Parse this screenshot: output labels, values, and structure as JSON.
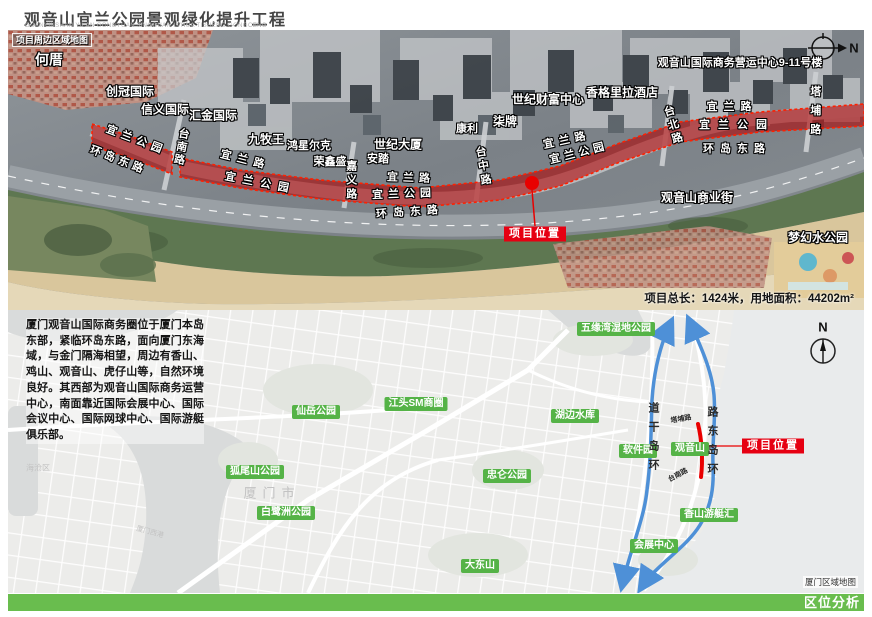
{
  "header": {
    "title": "观音山宜兰公园景观绿化提升工程",
    "subtitle": "GUANYINSHAN YILAN GONGYUAN JINGGUAN LVHUA TISHENG GONGCENG"
  },
  "colors": {
    "accent_green": "#69bd4e",
    "badge_green": "#55b347",
    "project_red": "#e60012",
    "band_red": "#b20000",
    "route_blue": "#4e90d7"
  },
  "top_map": {
    "corner_label": "项目周边区域地图",
    "compass_n": "N",
    "stats": "项目总长：1424米，用地面积：44202m²",
    "project_badge": "项目位置",
    "labels": [
      {
        "t": "何厝",
        "x": 41,
        "y": 30,
        "s": 14
      },
      {
        "t": "创冠国际",
        "x": 122,
        "y": 62
      },
      {
        "t": "信义国际",
        "x": 157,
        "y": 80
      },
      {
        "t": "汇金国际",
        "x": 205,
        "y": 86
      },
      {
        "t": "九牧王",
        "x": 258,
        "y": 110
      },
      {
        "t": "鸿星尔克",
        "x": 301,
        "y": 117,
        "s": 11
      },
      {
        "t": "荣鑫盛",
        "x": 322,
        "y": 133,
        "s": 11
      },
      {
        "t": "安踏",
        "x": 370,
        "y": 130,
        "s": 11
      },
      {
        "t": "世纪大厦",
        "x": 390,
        "y": 115
      },
      {
        "t": "康利",
        "x": 459,
        "y": 100,
        "s": 11
      },
      {
        "t": "柒牌",
        "x": 497,
        "y": 92
      },
      {
        "t": "世纪财富中心",
        "x": 540,
        "y": 70
      },
      {
        "t": "香格里拉酒店",
        "x": 614,
        "y": 63
      },
      {
        "t": "观音山国际商务营运中心9-11号楼",
        "x": 732,
        "y": 34,
        "s": 11
      },
      {
        "t": "观音山商业街",
        "x": 689,
        "y": 168
      },
      {
        "t": "梦幻水公园",
        "x": 810,
        "y": 208
      }
    ],
    "road_labels": [
      {
        "t": "宜兰公园",
        "x": 128,
        "y": 111,
        "r": 21,
        "ls": 5
      },
      {
        "t": "环岛东路",
        "x": 110,
        "y": 131,
        "r": 21,
        "ls": 4
      },
      {
        "t": "台南路",
        "x": 172,
        "y": 117,
        "v": 1,
        "r": 10,
        "ls": 2
      },
      {
        "t": "宜兰路",
        "x": 237,
        "y": 131,
        "r": 14,
        "ls": 6
      },
      {
        "t": "宜兰公园",
        "x": 252,
        "y": 154,
        "r": 11,
        "ls": 7
      },
      {
        "t": "嘉义路",
        "x": 342,
        "y": 151,
        "v": 1,
        "ls": 3
      },
      {
        "t": "宜兰路",
        "x": 403,
        "y": 149,
        "r": 2,
        "ls": 5
      },
      {
        "t": "宜兰公园",
        "x": 396,
        "y": 165,
        "r": -2,
        "ls": 5
      },
      {
        "t": "环岛东路",
        "x": 402,
        "y": 183,
        "r": -4,
        "ls": 6
      },
      {
        "t": "台中路",
        "x": 474,
        "y": 137,
        "v": 1,
        "r": -10,
        "ls": 3
      },
      {
        "t": "宜兰路",
        "x": 559,
        "y": 111,
        "r": -12,
        "ls": 5
      },
      {
        "t": "宜兰公园",
        "x": 571,
        "y": 124,
        "r": -14,
        "ls": 4
      },
      {
        "t": "台北路",
        "x": 664,
        "y": 96,
        "v": 1,
        "r": -16,
        "ls": 3
      },
      {
        "t": "宜兰路",
        "x": 724,
        "y": 78,
        "ls": 6
      },
      {
        "t": "宜兰公园",
        "x": 729,
        "y": 96,
        "ls": 8
      },
      {
        "t": "环岛东路",
        "x": 729,
        "y": 120,
        "ls": 6
      },
      {
        "t": "塔埔路",
        "x": 806,
        "y": 84,
        "v": 1,
        "ls": 8
      }
    ]
  },
  "lower_map": {
    "description": "厦门观音山国际商务圈位于厦门本岛东部，紧临环岛东路，面向厦门东海域，与金门隔海相望，周边有香山、鸡山、观音山、虎仔山等，自然环境良好。其西部为观音山国际商务运营中心，南面靠近国际会展中心、国际会议中心、国际网球中心、国际游艇俱乐部。",
    "project_badge": "项目位置",
    "compass_n": "N",
    "caption": "厦门区域地图",
    "badges": [
      {
        "t": "五缘湾湿地公园",
        "x": 608,
        "y": 19
      },
      {
        "t": "江头SM商圈",
        "x": 408,
        "y": 94
      },
      {
        "t": "仙岳公园",
        "x": 308,
        "y": 102
      },
      {
        "t": "湖边水库",
        "x": 567,
        "y": 106
      },
      {
        "t": "软件园",
        "x": 630,
        "y": 141
      },
      {
        "t": "观音山",
        "x": 682,
        "y": 139
      },
      {
        "t": "狐尾山公园",
        "x": 247,
        "y": 162
      },
      {
        "t": "忠仑公园",
        "x": 499,
        "y": 166
      },
      {
        "t": "白鹭洲公园",
        "x": 278,
        "y": 203
      },
      {
        "t": "香山游艇汇",
        "x": 701,
        "y": 205
      },
      {
        "t": "会展中心",
        "x": 646,
        "y": 236
      },
      {
        "t": "大东山",
        "x": 472,
        "y": 256
      }
    ],
    "road_names": [
      {
        "t": "塔埔路",
        "x": 673,
        "y": 109,
        "r": -10,
        "s": 7
      },
      {
        "t": "台南路",
        "x": 670,
        "y": 165,
        "r": -28,
        "s": 7
      }
    ],
    "vertical_roads": [
      {
        "t": "环岛干道",
        "x": 645,
        "y": 130,
        "rev": 1,
        "ls": 8
      },
      {
        "t": "环岛东路",
        "x": 704,
        "y": 134,
        "rev": 1,
        "ls": 8
      }
    ],
    "gray_labels": [
      {
        "t": "厦门市",
        "x": 264,
        "y": 182,
        "s": 13,
        "ls": 6
      },
      {
        "t": "海沧区",
        "x": 30,
        "y": 158,
        "s": 8
      },
      {
        "t": "厦门西港",
        "x": 142,
        "y": 222,
        "s": 7,
        "r": 15
      }
    ]
  },
  "footer": {
    "label": "区位分析"
  }
}
